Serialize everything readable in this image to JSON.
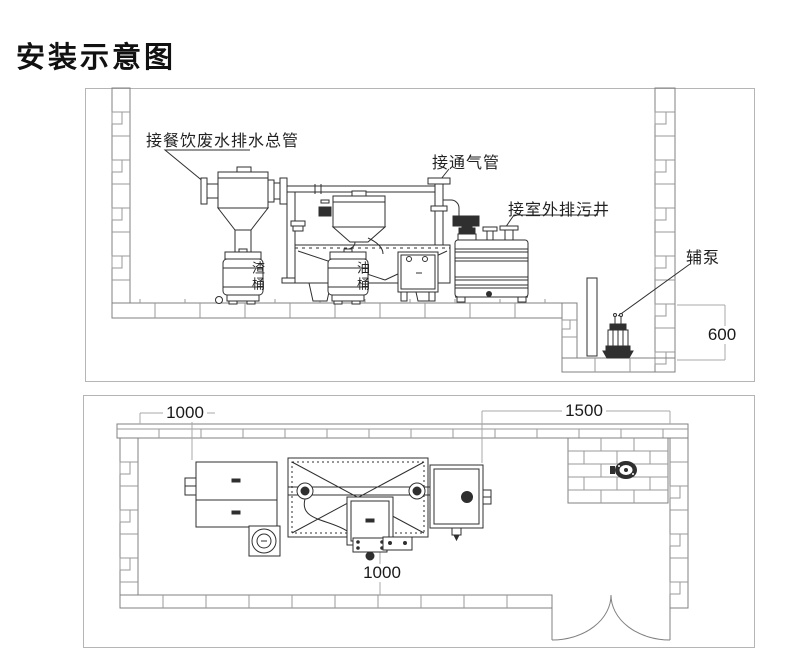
{
  "title": "安装示意图",
  "colors": {
    "line_dark": "#2f2f2f",
    "wall_gray": "#808080",
    "joint_gray": "#9a9a9a",
    "border_gray": "#b5b5b5",
    "dim_gray": "#a9a9a9",
    "text": "#1a1a1a"
  },
  "side_view": {
    "labels": {
      "inlet": "接餐饮废水排水总管",
      "vent": "接通气管",
      "sewage": "接室外排污井",
      "aux_pump": "辅泵",
      "slag_bucket": "渣桶",
      "oil_bucket": "油桶"
    },
    "dimensions": {
      "pit_depth": "600"
    }
  },
  "plan_view": {
    "dimensions": {
      "left_clearance": "1000",
      "right_clearance": "1500",
      "front_clearance": "1000"
    }
  }
}
